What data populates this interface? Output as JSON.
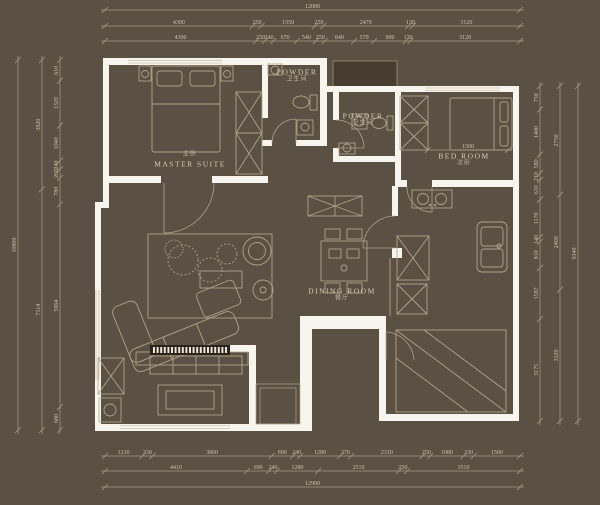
{
  "title": "apartment-floor-plan",
  "colors": {
    "background": "#5a5044",
    "wall": "#f8f5ee",
    "line": "#b5a88c",
    "dim_line": "#a89c81",
    "dim_text": "#cfc4a9",
    "label_text": "#d8cfb6",
    "dark_fill": "#463d30",
    "tv_dark": "#2a241c"
  },
  "rooms": [
    {
      "name": "MASTER SUITE",
      "sub": "主卧"
    },
    {
      "name": "POWDER",
      "sub": "卫生间"
    },
    {
      "name": "POWDER",
      "sub": "卫生间"
    },
    {
      "name": "BED ROOM",
      "sub": "次卧"
    },
    {
      "name": "DINING ROOM",
      "sub": "餐厅"
    }
  ],
  "dimensions": {
    "top": {
      "total": "12000",
      "row1": [
        "4300",
        "250",
        "1550",
        "250",
        "2470",
        "130",
        "3120"
      ],
      "row2": [
        "4300",
        "250",
        "240",
        "670",
        "540",
        "250",
        "840",
        "570",
        "900",
        "130",
        "3120"
      ]
    },
    "bottom": {
      "total": "12900",
      "row1": [
        "1210",
        "330",
        "3860",
        "690",
        "240",
        "1280",
        "370",
        "2310",
        "250",
        "1080",
        "330",
        "1500"
      ],
      "row2": [
        "4410",
        "690",
        "240",
        "1280",
        "2510",
        "250",
        "3510"
      ]
    },
    "left": {
      "total": "10800",
      "outer": [
        "3820",
        "7114"
      ],
      "inner": [
        "610",
        "1320",
        "1040",
        "240",
        "260",
        "780",
        "5964",
        "680"
      ]
    },
    "right": {
      "outer": [
        "9340"
      ],
      "mid": [
        "2750",
        "2400",
        "3320"
      ],
      "inner": [
        "730",
        "1400",
        "580",
        "210",
        "610",
        "1170",
        "140",
        "810",
        "1587",
        "3175"
      ]
    },
    "bedroom_inner": "1500"
  }
}
